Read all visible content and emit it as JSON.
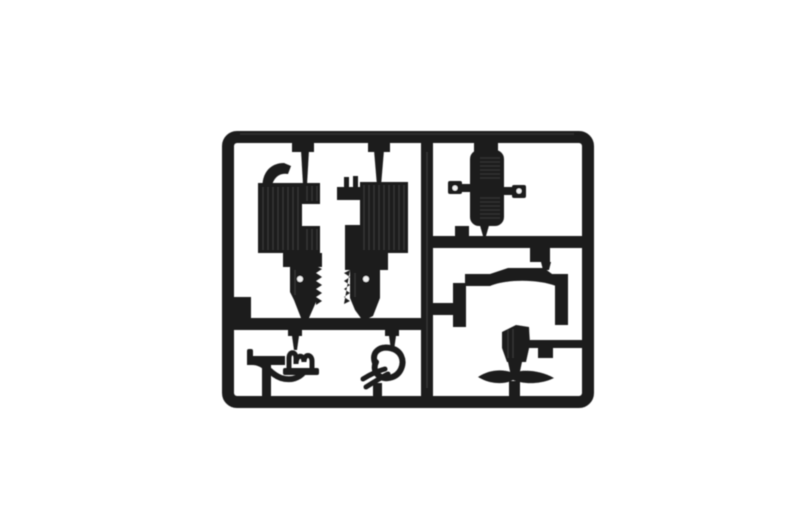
{
  "scene": {
    "type": "product-photo",
    "description": "Dark plastic model-kit sprue (injection molded parts tree) photographed on a plain white background",
    "background_color": "#ffffff"
  },
  "colors": {
    "background": "#ffffff",
    "plastic": "#1f1f1f",
    "plastic_deep": "#141414",
    "highlight": "#4a4a4a",
    "hole": "#f2f2f2"
  },
  "sprue": {
    "frame_shape": "rounded-rectangle",
    "runners": [
      "center-vertical",
      "right-horizontal-divider",
      "bottom-left-horizontal"
    ],
    "parts": [
      {
        "id": "engine-block-half-left",
        "cell": "top-left",
        "features": "ribbed block, top hook, spring shaft with hole"
      },
      {
        "id": "engine-block-half-right",
        "cell": "top-left",
        "features": "ribbed block, top nubs, spring shaft with hole"
      },
      {
        "id": "ribbed-tank",
        "cell": "top-right",
        "features": "rounded ribbed slab with two cross arms with holes"
      },
      {
        "id": "arched-bracket",
        "cell": "middle-right",
        "features": "arched top bar with two legs"
      },
      {
        "id": "seat-with-wing-base",
        "cell": "bottom-right",
        "features": "seat box, winged base, pedestal stem"
      },
      {
        "id": "curled-lever-left",
        "cell": "bottom-left",
        "features": "flat blade with coiled end"
      },
      {
        "id": "curled-lever-right",
        "cell": "bottom-left",
        "features": "open loop with two prongs"
      },
      {
        "id": "corner-square-tab",
        "cell": "left-frame",
        "features": "small molded square at runner junction"
      }
    ]
  }
}
